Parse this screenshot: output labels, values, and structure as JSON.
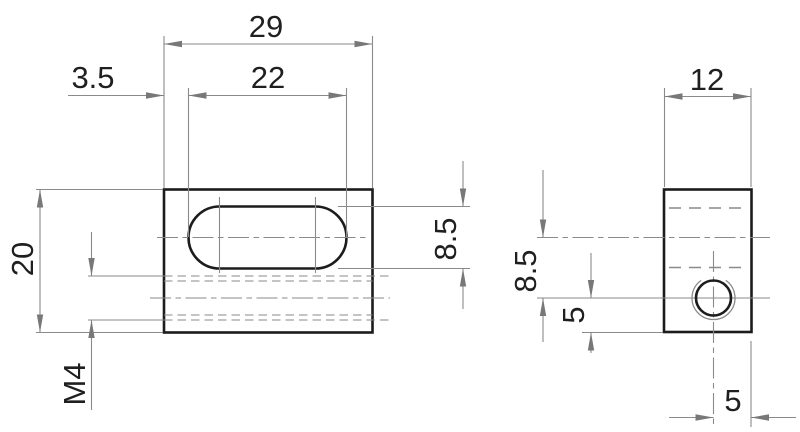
{
  "drawing": {
    "type": "engineering-drawing",
    "views": [
      "front-view",
      "side-view"
    ],
    "front_view": {
      "dims": {
        "overall_width": "29",
        "slot_offset": "3.5",
        "slot_length": "22",
        "overall_height": "20",
        "thread": "M4",
        "slot_width": "8.5"
      }
    },
    "side_view": {
      "dims": {
        "depth": "12",
        "slot_center_to_hole": "8.5",
        "hole_to_bottom": "5",
        "hole_to_edge": "5"
      }
    },
    "colors": {
      "outline": "#1c1c1c",
      "thin_line": "#8a8a8a",
      "text": "#1f1f1f",
      "background": "#ffffff"
    }
  }
}
